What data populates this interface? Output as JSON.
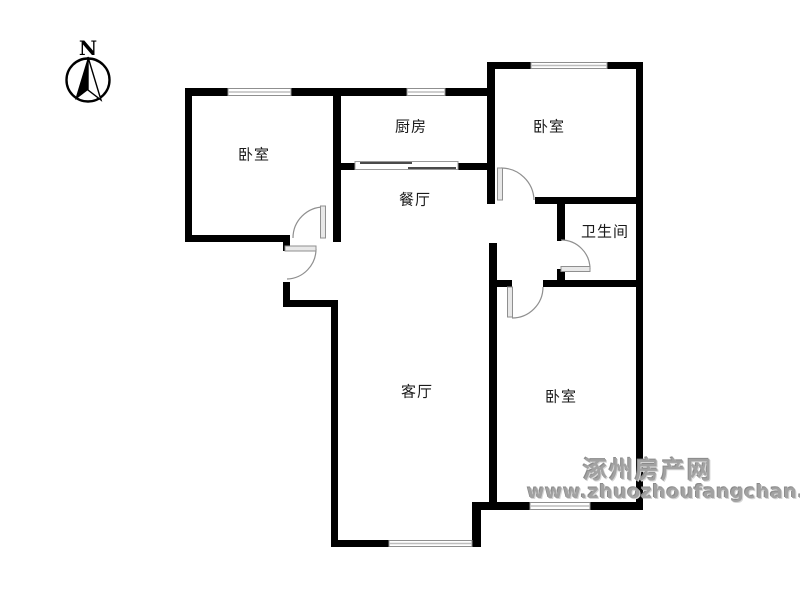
{
  "compass": {
    "north_label": "N"
  },
  "rooms": [
    {
      "id": "bedroom-left",
      "label": "卧室"
    },
    {
      "id": "kitchen",
      "label": "厨房"
    },
    {
      "id": "bedroom-top-right",
      "label": "卧室"
    },
    {
      "id": "dining-room",
      "label": "餐厅"
    },
    {
      "id": "bathroom",
      "label": "卫生间"
    },
    {
      "id": "living-room",
      "label": "客厅"
    },
    {
      "id": "bedroom-bottom-right",
      "label": "卧室"
    }
  ],
  "watermark": {
    "site_name": "涿州房产网",
    "site_url": "www.zhuozhoufangchan.com"
  },
  "colors": {
    "wall": "#000000",
    "window_frame": "#8f8f8f",
    "window_fill": "#ffffff",
    "door_leaf_fill": "#e8e8e8",
    "door_line": "#8f8f8f",
    "watermark_gray": "#a2a2a2",
    "background": "#ffffff",
    "label_text": "#1a1a1a"
  }
}
